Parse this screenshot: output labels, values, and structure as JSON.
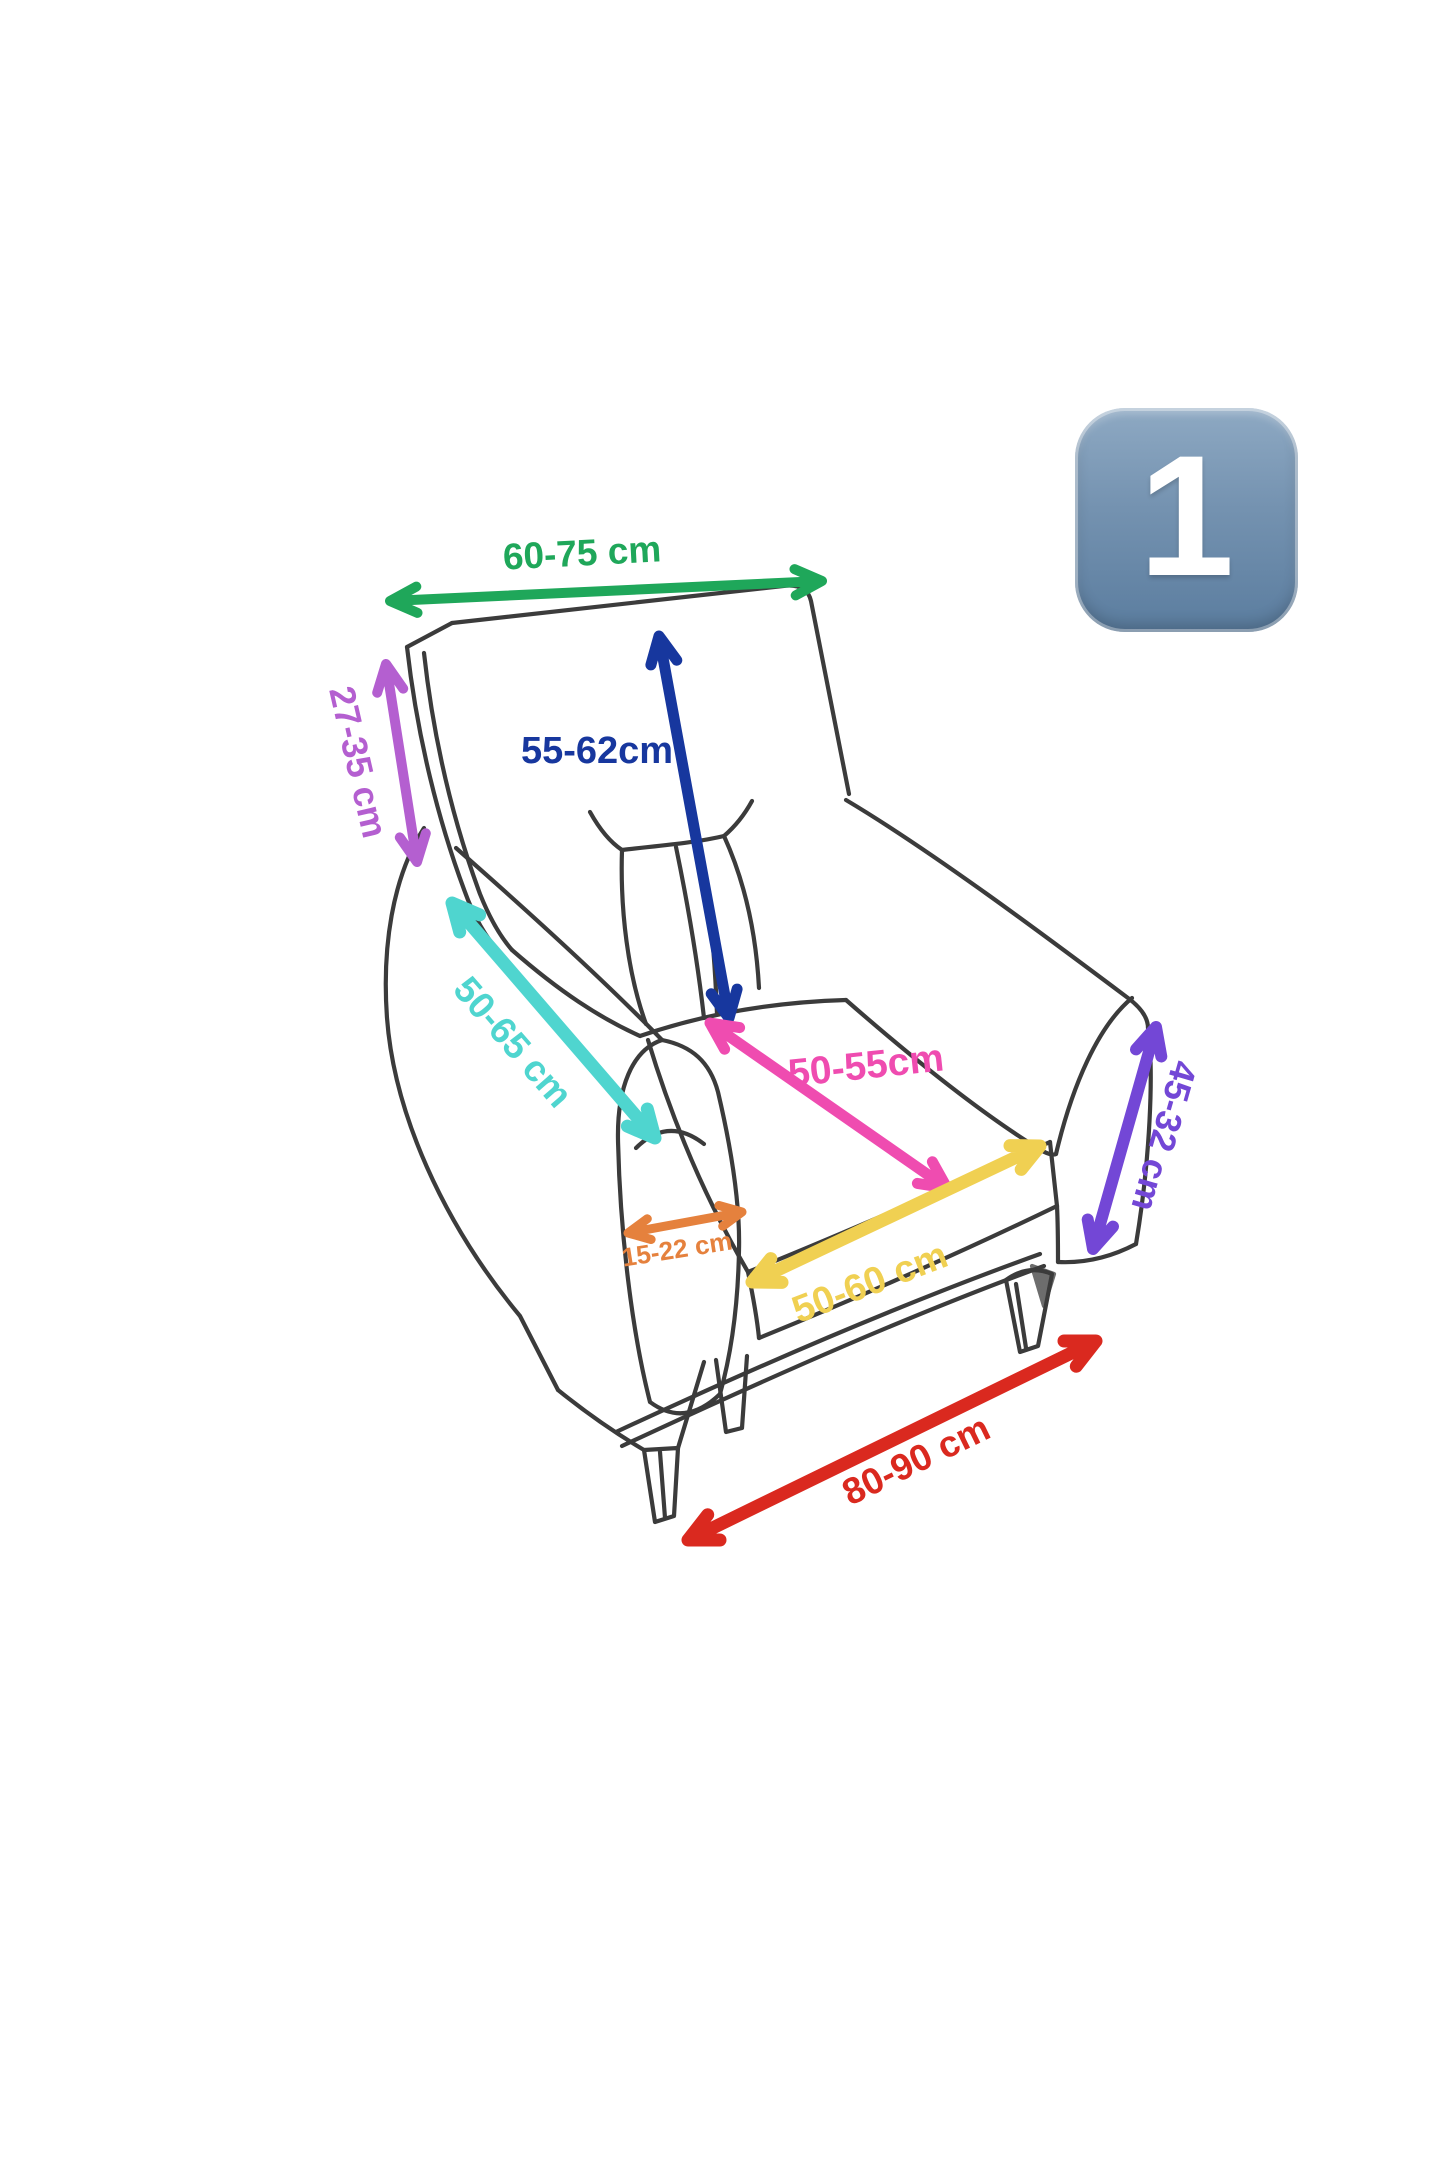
{
  "canvas": {
    "background": "#ffffff"
  },
  "badge": {
    "label": "1",
    "color_top": "#8ea9c3",
    "color_mid": "#7492b0",
    "color_bottom": "#5b7d9f",
    "text_color": "#ffffff"
  },
  "sketch": {
    "stroke_color": "#2b2b2b"
  },
  "measurements": [
    {
      "id": "back-width",
      "value": "60-75 cm",
      "color": "#1fa75a"
    },
    {
      "id": "back-side-height",
      "value": "27-35 cm",
      "color": "#b45fd0"
    },
    {
      "id": "back-height",
      "value": "55-62cm",
      "color": "#17379e"
    },
    {
      "id": "armrest-length",
      "value": "50-65 cm",
      "color": "#4fd5cf"
    },
    {
      "id": "seat-depth",
      "value": "50-55cm",
      "color": "#ef4cb0"
    },
    {
      "id": "armrest-front-width",
      "value": "15-22 cm",
      "color": "#e5813d"
    },
    {
      "id": "seat-front-width",
      "value": "50-60 cm",
      "color": "#f0d052"
    },
    {
      "id": "arm-side-height",
      "value": "45-32 cm",
      "color": "#7347d6"
    },
    {
      "id": "base-width",
      "value": "80-90 cm",
      "color": "#da291f"
    }
  ]
}
